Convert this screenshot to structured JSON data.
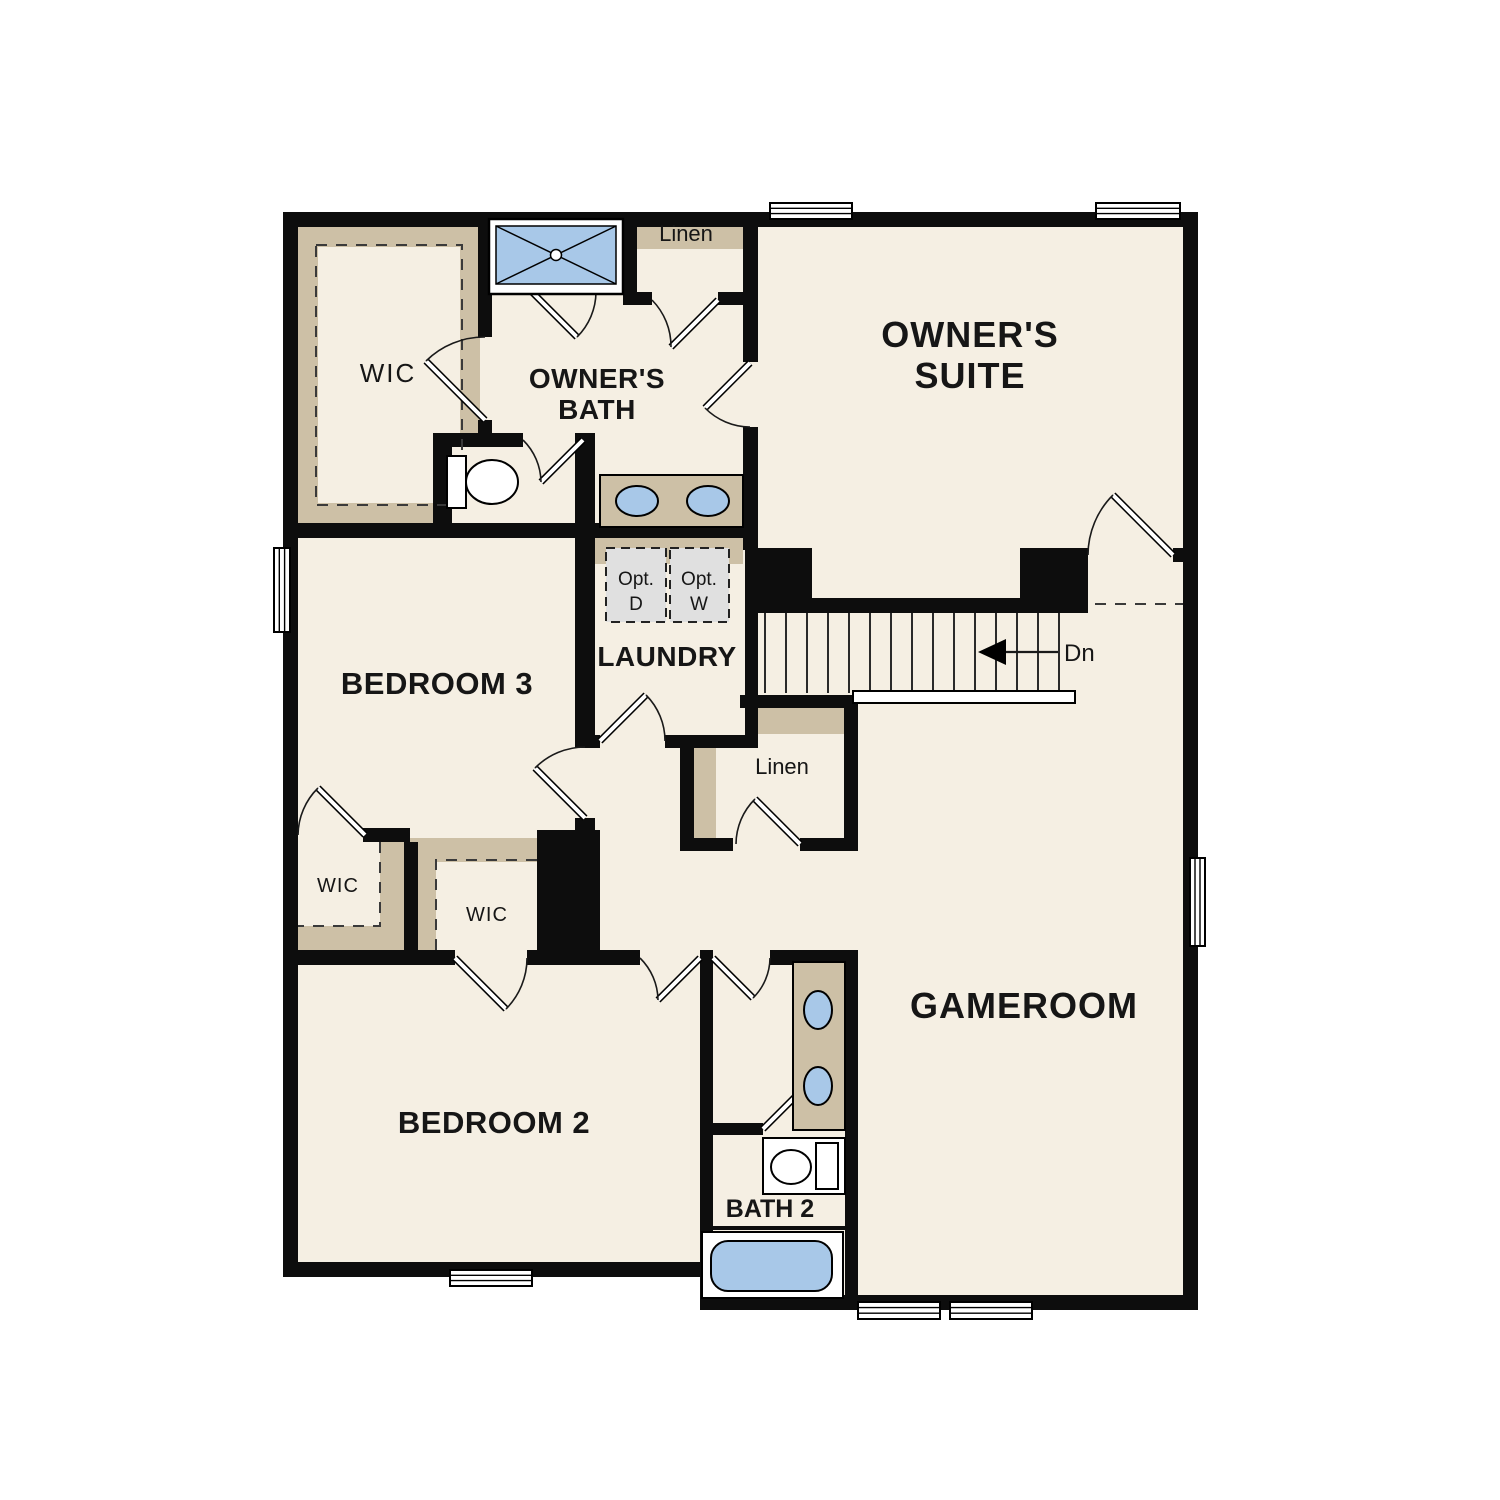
{
  "palette": {
    "background": "#ffffff",
    "wall_black": "#0d0d0d",
    "floor_cream": "#f5efe3",
    "closet_shelf_tan": "#cdc0a6",
    "fixture_blue": "#a8c8e8",
    "optional_appliance_gray": "#e0e0e0",
    "label_text": "#161616"
  },
  "rooms": {
    "owners_suite": {
      "label_line1": "OWNER'S",
      "label_line2": "SUITE"
    },
    "owners_bath": {
      "label_line1": "OWNER'S",
      "label_line2": "BATH"
    },
    "wic_owners": {
      "label": "WIC"
    },
    "linen_bath": {
      "label": "Linen"
    },
    "laundry": {
      "label": "LAUNDRY"
    },
    "linen_hall": {
      "label": "Linen"
    },
    "bedroom3": {
      "label": "BEDROOM 3"
    },
    "wic_bedroom3": {
      "label": "WIC"
    },
    "wic_bedroom2": {
      "label": "WIC"
    },
    "bedroom2": {
      "label": "BEDROOM 2"
    },
    "bath2": {
      "label": "BATH 2"
    },
    "gameroom": {
      "label": "GAMEROOM"
    }
  },
  "laundry_options": {
    "dryer": {
      "line1": "Opt.",
      "line2": "D"
    },
    "washer": {
      "line1": "Opt.",
      "line2": "W"
    }
  },
  "stairs": {
    "direction_label": "Dn",
    "tread_count": 15
  },
  "fixtures": {
    "shower": "shower-pan-icon",
    "owners_bath_vanity": "double-sink-vanity-icon",
    "owners_bath_toilet": "toilet-icon",
    "bath2_vanity": "double-sink-vanity-icon",
    "bath2_toilet": "toilet-icon",
    "bath2_tub": "bathtub-icon"
  }
}
